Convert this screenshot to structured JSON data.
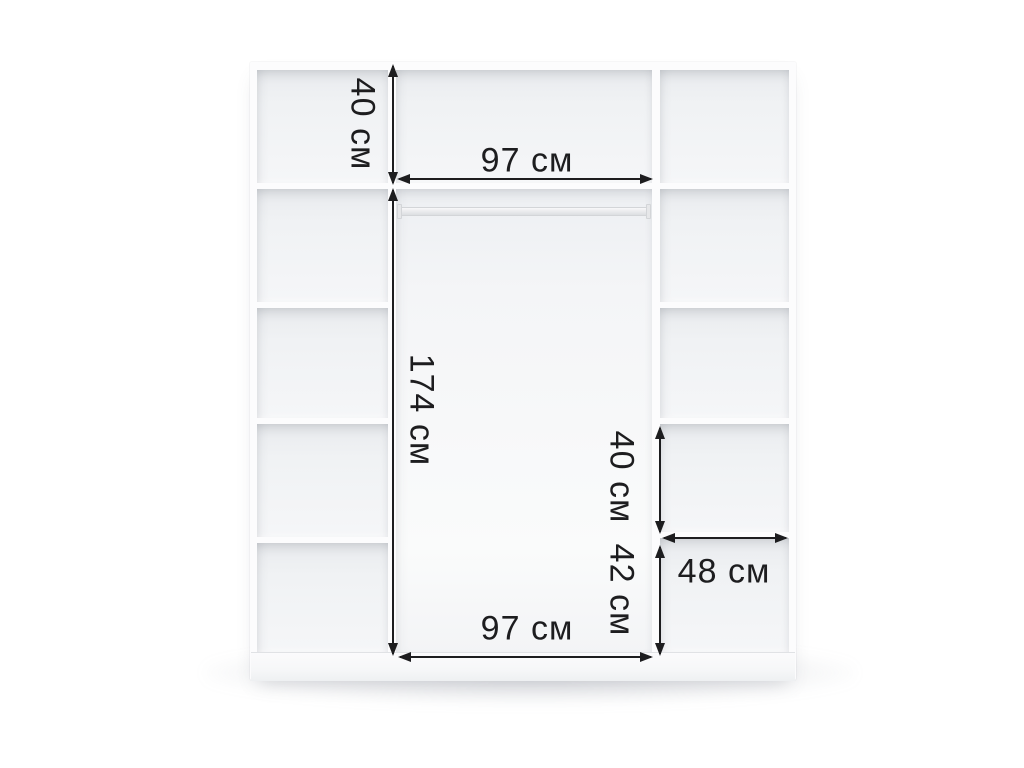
{
  "diagram": {
    "name": "wardrobe-interior-dimensions",
    "unit_label": "см",
    "ink_color": "#1d1d1f",
    "background_color": "#ffffff",
    "furniture_color": "#fcfcfd"
  },
  "dimension_labels": {
    "top_left_height": "40 см",
    "top_width": "97 см",
    "middle_height": "174 см",
    "right_upper_height": "40 см",
    "right_shelf_width": "48 см",
    "right_lower_height": "42 см",
    "bottom_width": "97 см"
  },
  "structure": {
    "left_column_cells": 5,
    "right_column_cells": 5,
    "top_row_cells": 3,
    "hanging_rod": "present"
  }
}
